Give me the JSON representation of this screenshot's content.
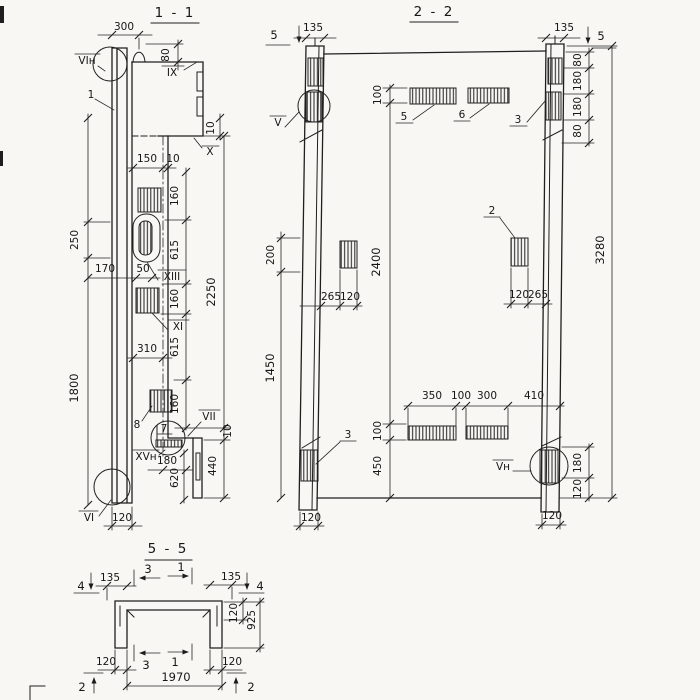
{
  "colors": {
    "ink": "#1f1f1f",
    "paper": "#f8f7f3"
  },
  "s11": {
    "title": "1 - 1",
    "d300": "300",
    "d80": "80",
    "l_vin": "VIн",
    "l_1": "1",
    "l_ix": "IX",
    "d10_ix": "10",
    "l_x": "X",
    "d150": "150",
    "d10_step": "10",
    "d160a": "160",
    "d615a": "615",
    "l_xiii": "XIII",
    "d50": "50",
    "d170": "170",
    "d250": "250",
    "d160b": "160",
    "l_xi": "XI",
    "d615b": "615",
    "d310": "310",
    "d160c": "160",
    "l_8": "8",
    "l_7": "7",
    "l_vii": "VII",
    "d10_vii": "10",
    "l_xvn": "XVн",
    "d180": "180",
    "d620": "620",
    "d440": "440",
    "d2250": "2250",
    "d1800": "1800",
    "l_vi": "VI",
    "d120": "120"
  },
  "s22": {
    "title": "2 - 2",
    "m5l": "5",
    "m5r": "5",
    "d135l": "135",
    "d135r": "135",
    "l_v": "V",
    "d100t": "100",
    "l_5": "5",
    "l_6": "6",
    "l_3t": "3",
    "d80a": "80",
    "d180a": "180",
    "d180b": "180",
    "d80b": "80",
    "d200": "200",
    "l_2": "2",
    "d2400": "2400",
    "d3280": "3280",
    "d265l": "265",
    "d120l": "120",
    "d120r": "120",
    "d265r": "265",
    "d1450": "1450",
    "d350": "350",
    "d100m": "100",
    "d300": "300",
    "d410": "410",
    "d100b": "100",
    "l_3b": "3",
    "d450": "450",
    "l_vn": "Vн",
    "d180c": "180",
    "d120c": "120",
    "d120cl": "120",
    "d120cr": "120"
  },
  "s55": {
    "title": "5 - 5",
    "m4l": "4",
    "d135l": "135",
    "m3t": "3",
    "m1t": "1",
    "d135r": "135",
    "m4r": "4",
    "d120r": "120",
    "d925": "925",
    "d120bl": "120",
    "m3b": "3",
    "m1b": "1",
    "d120br": "120",
    "d1970": "1970",
    "m2l": "2",
    "m2r": "2"
  }
}
